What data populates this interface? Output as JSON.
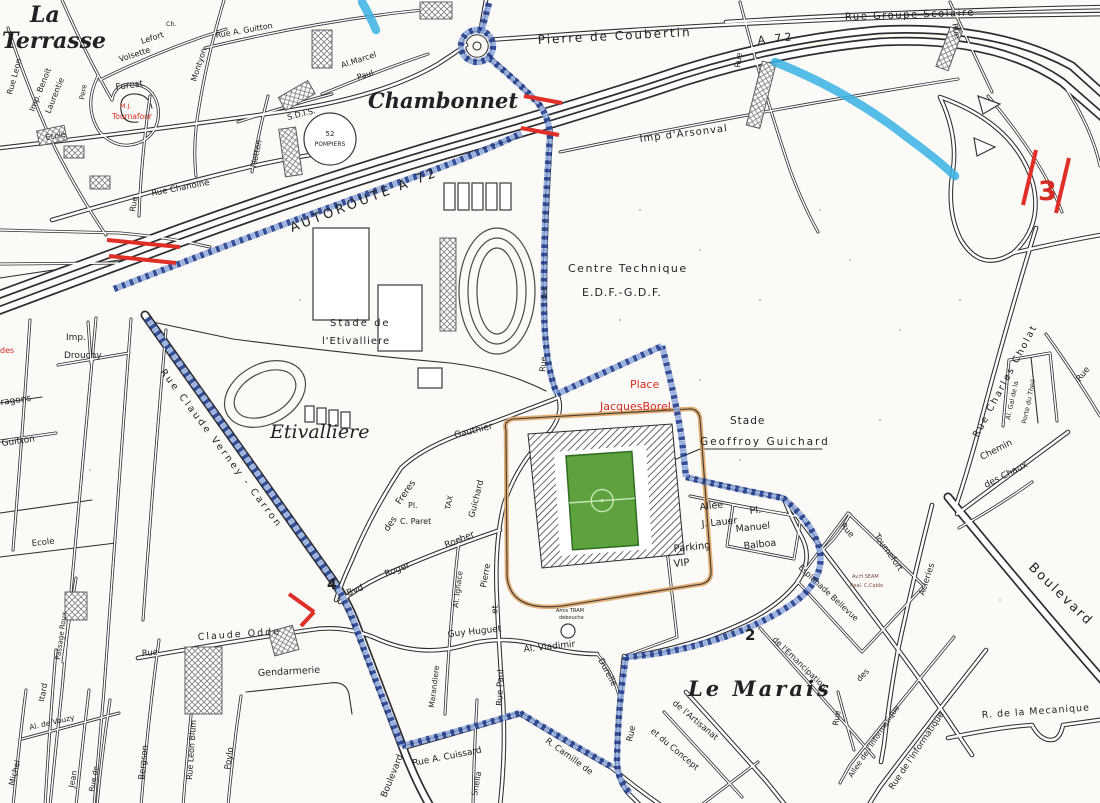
{
  "colors": {
    "route_blue": "#24408f",
    "route_blue_light": "#8aa4dc",
    "highlight_cyan": "#38b2e5",
    "mark_red": "#df2f26",
    "pitch_green": "#5da23d",
    "stadium_outline_orange": "#e0aa6b",
    "ink": "#2e2e2e",
    "paper": "#fbfaf7"
  },
  "districts": {
    "la1": "La",
    "la2": "Terrasse",
    "chambonnet": "Chambonnet",
    "etivalliere": "Etivalliere",
    "lemarais": "Le Marais"
  },
  "labels": {
    "rue_leon": "Rue Leon",
    "imp_benoit": "Imp. Benoit",
    "laurentie": "Laurentie",
    "pere": "Pere",
    "forest": "Forest",
    "tournafour1": "M.J.",
    "tournafour2": "Tournafour",
    "lefort": "Lefort",
    "volsette": "Volsette",
    "montyon": "Montyon",
    "rue_a_guitton": "Rue A. Guitton",
    "ch": "Ch.",
    "ecole_top": "Ecole",
    "rue_chanoine": "Rue Chanoine",
    "plotton": "Plotton",
    "sdis": "S.D.I.S.",
    "pompiers1": "52",
    "pompiers2": "POMPIERS",
    "al_marcel": "Al.Marcel",
    "paul": "Paul",
    "rue_frag_tl": "Rue",
    "coubertin": "Pierre de Coubertin",
    "a72_top": "A 72",
    "autoroute": "AUTOROUTE A 72",
    "arsonval": "Imp d'Arsonval",
    "groupe_scolaire": "Rue Groupe Scolaire",
    "rue_h": "Rue",
    "rue_r": "Rue",
    "centre_tech": "Centre Technique",
    "edf": "E.D.F.-G.D.F.",
    "stade_de": "Stade de",
    "l_etivalliere": "l'Etivalliere",
    "rue_des_v1": "Rue",
    "rue_des_v2": "des",
    "place_red": "Place",
    "jacques_red": "JacquesBorel",
    "stade2": "Stade",
    "geoffroy": "Geoffroy Guichard",
    "allee": "Allee",
    "j_lauer": "J. Lauer",
    "pl": "Pl.",
    "manuel": "Manuel",
    "balboa": "Balboa",
    "parking": "Parking",
    "vip": "VIP",
    "amis_tram": "Amis TRAM",
    "debouche": "debouche",
    "gauthier": "Gauthier",
    "st_freres": "Freres",
    "st_des": "des",
    "paret_pl": "Pl.",
    "paret": "C. Paret",
    "tax": "TAX",
    "bvd": "Bvd",
    "roger": "Roger",
    "rocher": "Rocher",
    "al_ignace": "Al. Ignace",
    "marandiere": "Marandiere",
    "guichard_v": "Guichard",
    "pierre_v": "Pierre",
    "et_v": "et",
    "rue_paul_v": "Rue Paul",
    "guy_huguet": "Guy Huguet",
    "al_vladimir": "Al. Vladimir",
    "durelle": "Durelle",
    "cuissard": "Rue A. Cuissard",
    "camille": "R. Camille de",
    "snella": "Snella",
    "boulevard_bl": "Boulevard",
    "imp2": "Imp.",
    "drouchy": "Drouchy",
    "verney": "Rue Claude Verney - Carron",
    "guitton2": "Guitton",
    "dragons": "Dragons",
    "ecole2": "Ecole",
    "michel": "Michel",
    "itard": "Itard",
    "jean": "Jean",
    "rue_de_v": "Rue de",
    "passage_roux": "Passage Roux",
    "al_vouzy": "Al. de Vouzy",
    "bergson": "Bergson",
    "rue2": "Rue",
    "claude_odde": "Claude Odde",
    "leon_blum": "Rue Leon Blum",
    "poylo": "Poylo",
    "gendarmerie": "Gendarmerie",
    "red_des": "des",
    "rue_v_bc": "Rue",
    "artisanat": "de l'Artisanat",
    "concept": "et du Concept",
    "emancipation": "de l'Emancipation",
    "mecanique": "R. de la Mecanique",
    "informatique1": "Rue de l'Informatique",
    "informatique2": "Allee de l'Informatique",
    "des_br": "des",
    "rue_br": "Rue",
    "esplanade": "Esplanade Bellevue",
    "av_seam": "Av.H SEAM",
    "real_cable": "Real. C.Cable",
    "tournefort_rue": "Rue",
    "tournefort": "Tournefort",
    "acieries": "Acieries",
    "boulevard_r": "Boulevard",
    "cholat": "Rue Charles Cholat",
    "porte1": "Al. Gal de la",
    "porte2": "Porte du Theil",
    "chemin": "Chemin",
    "chaux": "des Chaux",
    "rue_re": "Rue"
  },
  "markers": {
    "m2": "2",
    "m3": "3",
    "m4": "4"
  }
}
